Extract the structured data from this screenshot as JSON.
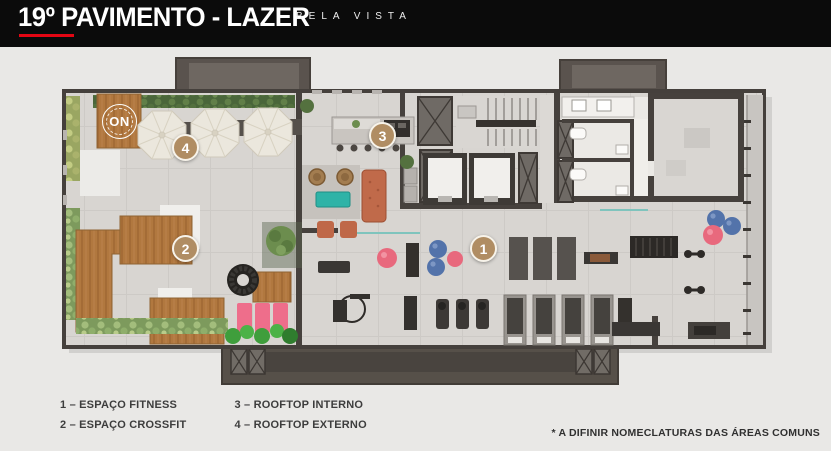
{
  "header": {
    "title": "19º PAVIMENTO - LAZER",
    "subtitle": "BELA VISTA",
    "bg_color": "#0b0b0b",
    "accent_color": "#e30613"
  },
  "plan": {
    "logo": {
      "text": "ON"
    },
    "markers": [
      {
        "number": "1",
        "label": "ESPAÇO FITNESS"
      },
      {
        "number": "2",
        "label": "ESPAÇO CROSSFIT"
      },
      {
        "number": "3",
        "label": "ROOFTOP INTERNO"
      },
      {
        "number": "4",
        "label": "ROOFTOP EXTERNO"
      }
    ],
    "colors": {
      "marker": "#b08d63",
      "wall": "#46413d",
      "floor": "#d8d5d1",
      "wood_deck": "#b1783f",
      "hedge_green": "#4a663a",
      "bright_green": "#3f9e3c",
      "pink_equipment": "#ee6e8b",
      "blue_ball": "#5373aa",
      "teal_table": "#2fb3a7",
      "terracotta_sofa": "#c06a4a",
      "background": "#e9e8e6"
    }
  },
  "legend": {
    "items": [
      {
        "text": "1 – ESPAÇO FITNESS"
      },
      {
        "text": "2 – ESPAÇO CROSSFIT"
      },
      {
        "text": "3 – ROOFTOP INTERNO"
      },
      {
        "text": "4 – ROOFTOP EXTERNO"
      }
    ]
  },
  "footnote": {
    "text": "* A DIFINIR NOMECLATURAS DAS ÁREAS COMUNS"
  }
}
